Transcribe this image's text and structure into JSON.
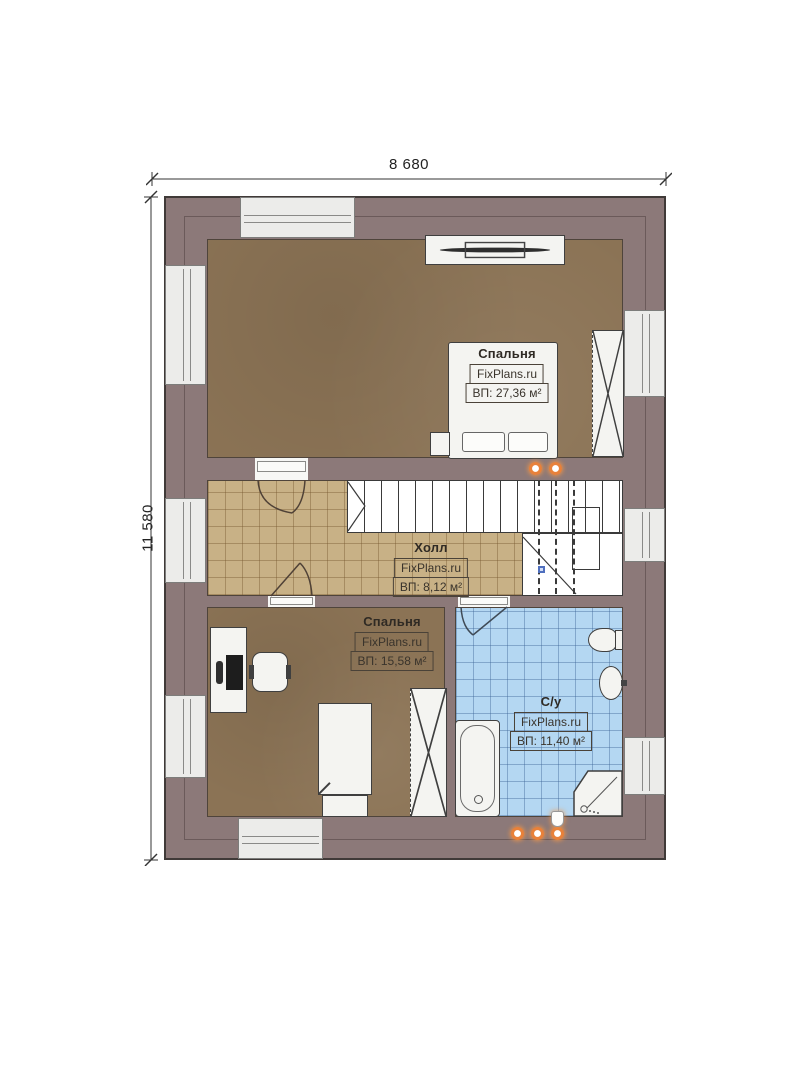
{
  "drawing": {
    "type_note": "floor plan",
    "dimensions": {
      "width_label": "8 680",
      "height_label": "11 580"
    },
    "branding": {
      "watermark": "FixPlans.ru"
    },
    "rooms": [
      {
        "name": "Спальня",
        "watermark": "FixPlans.ru",
        "area": "ВП: 27,36 м²"
      },
      {
        "name": "Холл",
        "watermark": "FixPlans.ru",
        "area": "ВП: 8,12 м²"
      },
      {
        "name": "Спальня",
        "watermark": "FixPlans.ru",
        "area": "ВП: 15,58 м²"
      },
      {
        "name": "С/у",
        "watermark": "FixPlans.ru",
        "area": "ВП: 11,40 м²"
      }
    ],
    "colors": {
      "wall": "#8c7979",
      "floor_wood": "#8b7355",
      "floor_tile_hall": "#c8b186",
      "floor_tile_bath": "#b4d7f2",
      "window": "#ececea",
      "spot_dot": "#e8813a"
    }
  }
}
